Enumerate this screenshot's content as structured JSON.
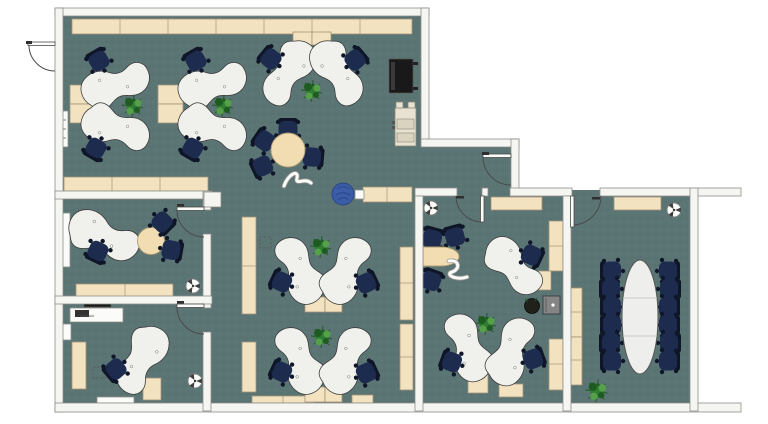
{
  "meta": {
    "type": "office-floor-plan",
    "view": "top-down",
    "no_visible_text": true
  },
  "palette": {
    "outside": "#ffffff",
    "floor": "#5b7574",
    "wall": "#f5f5f1",
    "wall_stroke": "#8e8e8a",
    "desk": "#f0f0ed",
    "desk_stroke": "#3a3a3a",
    "cabinet": "#f3e2c0",
    "cabinet_stroke": "#a3937a",
    "chair": "#1d2b4f",
    "chair_dark": "#0e1628",
    "table_wood": "#f2ddb2",
    "conference_table": "#eeeeec",
    "plant_dark": "#1e5b21",
    "plant_mid": "#2f7d33",
    "plant_light": "#55a049",
    "pouf": "#3b5ca6",
    "armchair": "#89a3c7",
    "black_furniture": "#191919",
    "copier": "#e7e2d1",
    "safe": "#858585"
  },
  "floorplan": {
    "rooms": [
      {
        "name": "open-plan-office",
        "desks": 10,
        "task_chairs": 10,
        "round_meeting_table": 1,
        "meeting_chairs": 4,
        "plants": 5,
        "pouf": 1,
        "armchair": 1,
        "sideboard": 1,
        "copier": 1,
        "cabinet_runs": 9,
        "decor_items": 1,
        "radiator": 1
      },
      {
        "name": "office-left-upper",
        "desks": 1,
        "chairs": 3,
        "side_table": 1,
        "cabinet_runs": 2,
        "white_cabinet": 1,
        "fan": 1
      },
      {
        "name": "office-left-lower",
        "desks": 1,
        "chairs": 1,
        "workbench": 1,
        "cabinet_runs": 2,
        "fan": 1,
        "window_sill": 1
      },
      {
        "name": "team-office",
        "desks": 3,
        "chairs": 6,
        "plants": 1,
        "planter_pot": 1,
        "safe": 1,
        "side_table": 1,
        "cabinet_runs": 5,
        "decor_items": 1,
        "fan": 1
      },
      {
        "name": "meeting-room",
        "conference_table": 1,
        "chairs": 12,
        "plants": 1,
        "cabinet_runs": 3,
        "fan": 1
      }
    ],
    "doors": {
      "exterior": 1,
      "interior": 6
    }
  }
}
